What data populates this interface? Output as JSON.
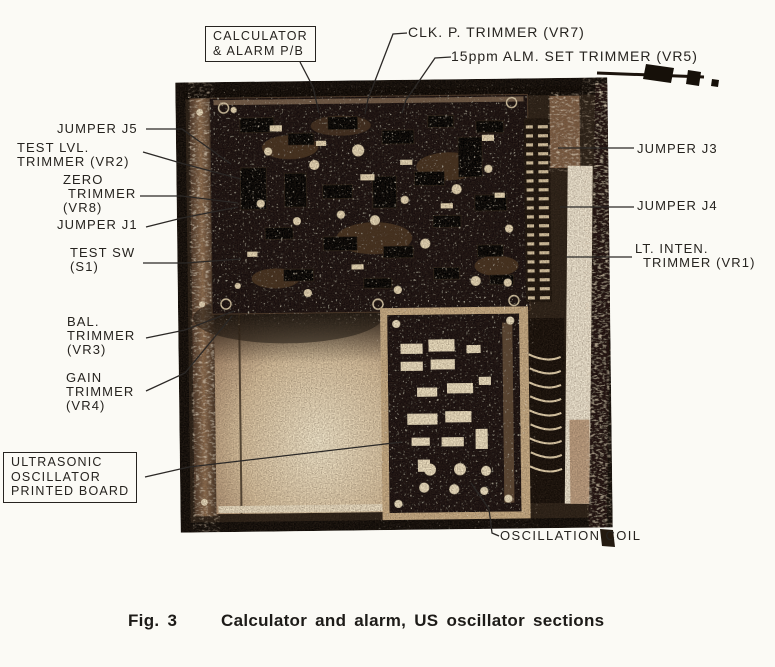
{
  "caption": {
    "fig": "Fig. 3",
    "text": "Calculator and alarm, US oscillator sections"
  },
  "labels": {
    "calc_box": {
      "line1": "CALCULATOR",
      "line2": "& ALARM P/B"
    },
    "clk_trimmer": "CLK. P. TRIMMER (VR7)",
    "alm_trimmer": "15ppm ALM. SET TRIMMER (VR5)",
    "jumper_j5": "JUMPER J5",
    "test_lvl": {
      "line1": "TEST LVL.",
      "line2": "TRIMMER (VR2)"
    },
    "zero": {
      "line1": "ZERO",
      "line2": "TRIMMER",
      "line3": "(VR8)"
    },
    "jumper_j1": "JUMPER J1",
    "test_sw": {
      "line1": "TEST SW",
      "line2": "(S1)"
    },
    "bal": {
      "line1": "BAL.",
      "line2": "TRIMMER",
      "line3": "(VR3)"
    },
    "gain": {
      "line1": "GAIN",
      "line2": "TRIMMER",
      "line3": "(VR4)"
    },
    "ultra_box": {
      "line1": "ULTRASONIC",
      "line2": "OSCILLATOR",
      "line3": "PRINTED BOARD"
    },
    "jumper_j3": "JUMPER J3",
    "jumper_j4": "JUMPER J4",
    "lt_inten": {
      "line1": "LT. INTEN.",
      "line2": "TRIMMER (VR1)"
    },
    "osc_coil": "OSCILLATION COIL"
  },
  "colors": {
    "ink": "#26231f",
    "paper": "#fbfaf5"
  }
}
